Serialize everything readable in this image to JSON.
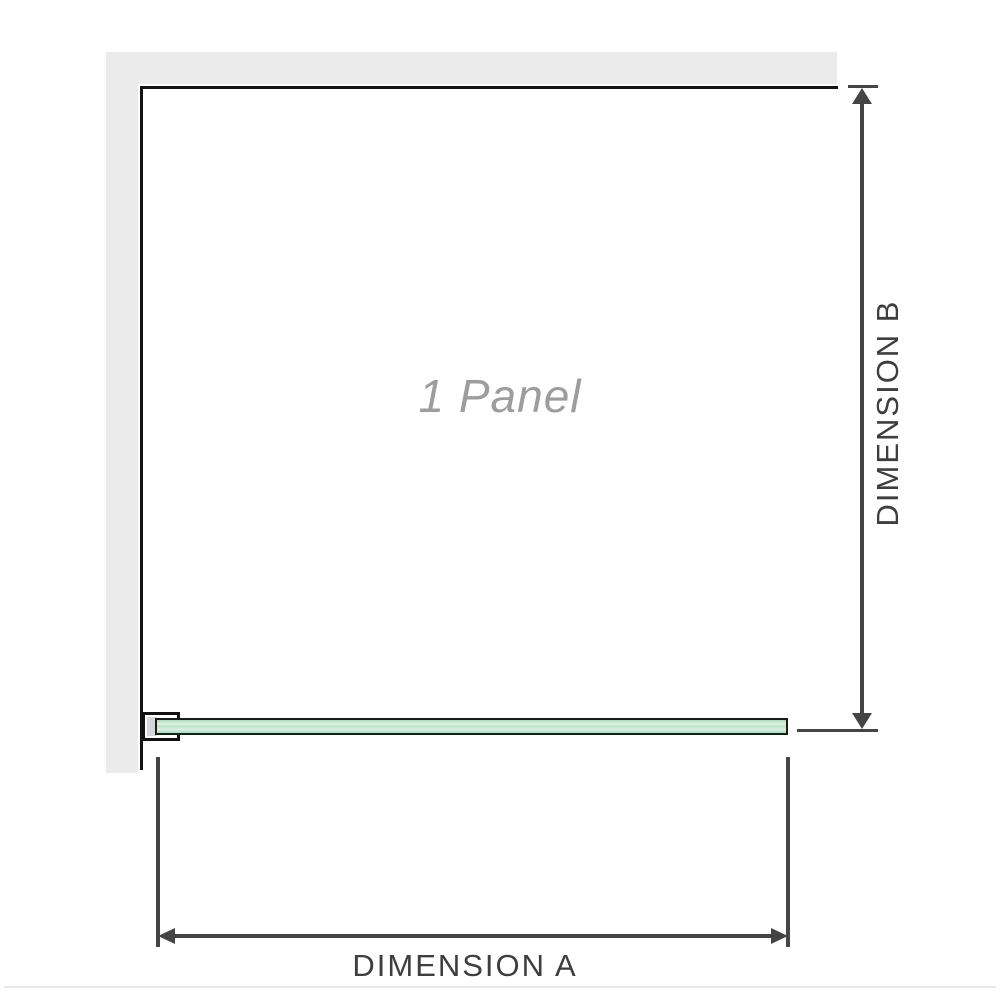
{
  "diagram": {
    "title": "shower-screen-panel-dimension-diagram",
    "panel_label": "1 Panel",
    "dimension_a": {
      "label": "DIMENSION A",
      "orientation": "horizontal"
    },
    "dimension_b": {
      "label": "DIMENSION B",
      "orientation": "vertical"
    },
    "colors": {
      "wall": "#ebebeb",
      "frame": "#141414",
      "glass_fill": "#a8dcb8",
      "glass_highlight": "#ddf1e4",
      "glass_outline": "#1c1c1c",
      "dimension": "#454545",
      "label_text": "#3e3e3e",
      "panel_text": "#9d9d9d",
      "clamp_pad": "#d6d6d6",
      "baseline": "#e8e8e8"
    }
  }
}
